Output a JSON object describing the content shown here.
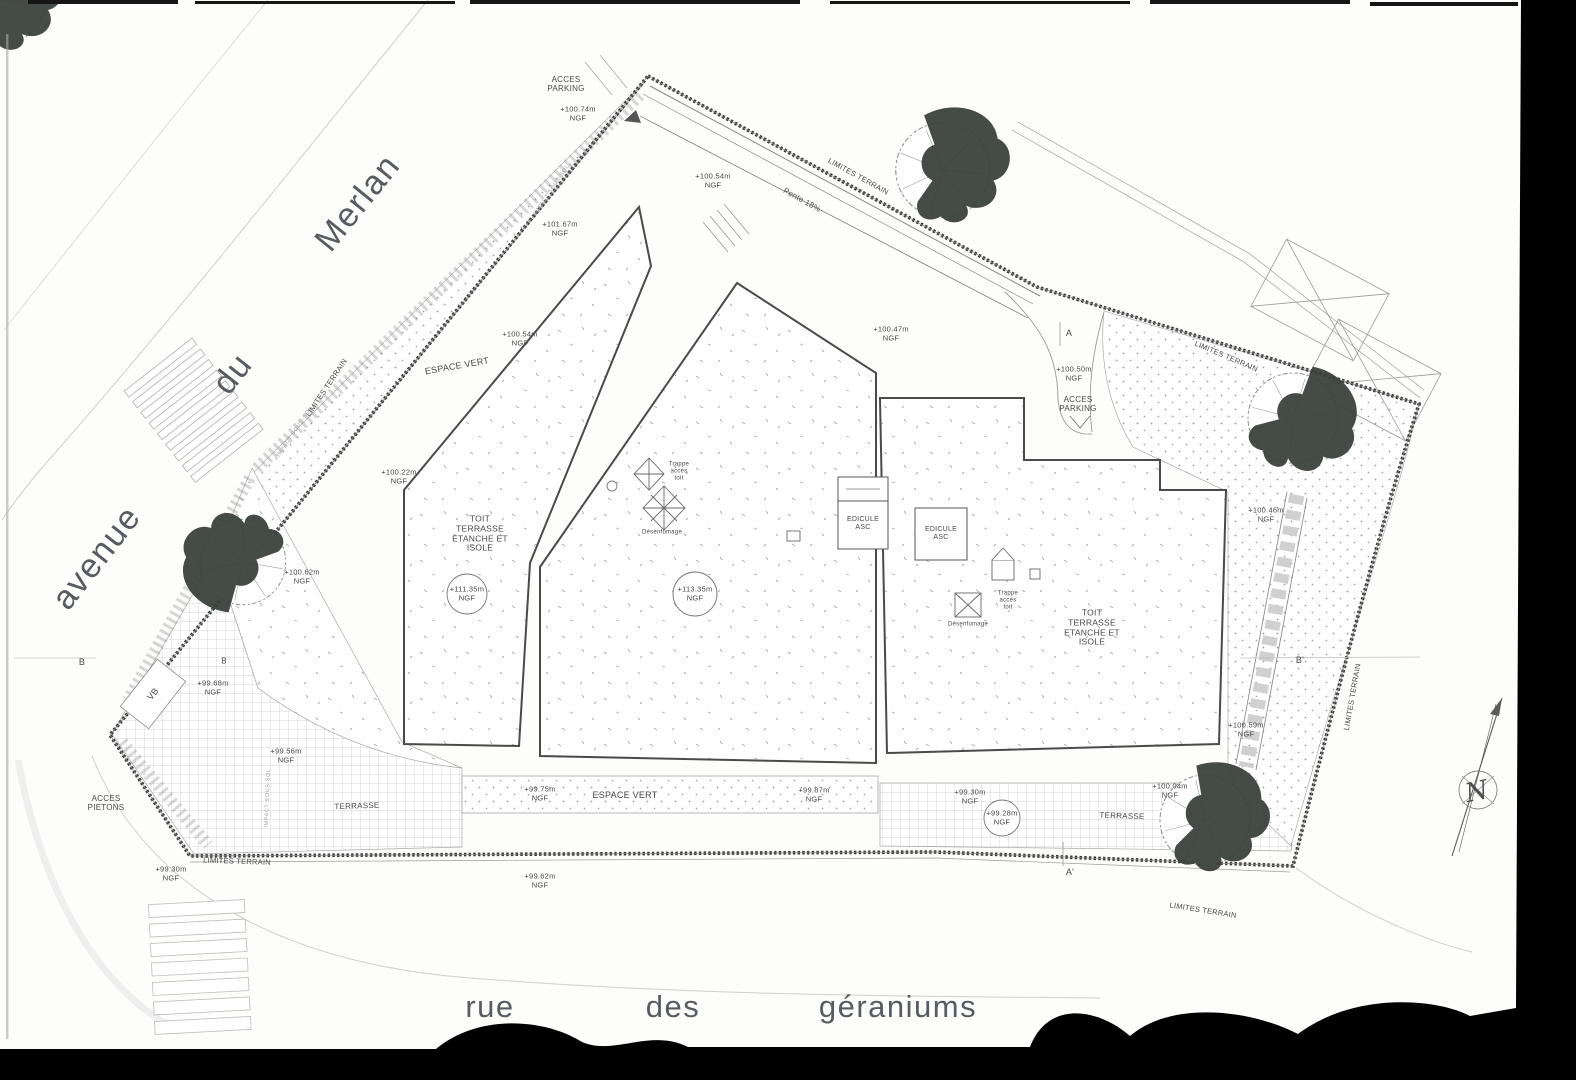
{
  "plan": {
    "type": "architect site plan (plan de masse) – roof level, scanned",
    "streets": {
      "avenue": "avenue du Merlan",
      "rue": "rue des géraniums"
    },
    "colors": {
      "ink": "#474747",
      "line": "#555555",
      "faint": "#bcbcbc",
      "scan_border": "#000000",
      "tree": "#39403b"
    },
    "labels": [
      {
        "name": "street-word-avenue",
        "cls": "street",
        "lines": [
          "avenue"
        ],
        "x": 97,
        "y": 558,
        "rot": -52,
        "size": 34
      },
      {
        "name": "street-word-du",
        "cls": "street",
        "lines": [
          "du"
        ],
        "x": 233,
        "y": 374,
        "rot": -52,
        "size": 34
      },
      {
        "name": "street-word-merlan",
        "cls": "street",
        "lines": [
          "Merlan"
        ],
        "x": 358,
        "y": 203,
        "rot": -51,
        "size": 34
      },
      {
        "name": "street-word-rue",
        "cls": "street",
        "lines": [
          "rue"
        ],
        "x": 490,
        "y": 1007,
        "rot": 0,
        "size": 31
      },
      {
        "name": "street-word-des",
        "cls": "street",
        "lines": [
          "des"
        ],
        "x": 673,
        "y": 1007,
        "rot": 0,
        "size": 31
      },
      {
        "name": "street-word-geraniums",
        "cls": "street",
        "lines": [
          "géraniums"
        ],
        "x": 898,
        "y": 1007,
        "rot": 0,
        "size": 31
      },
      {
        "name": "limites-terrain-left",
        "lines": [
          "LIMITES TERRAIN"
        ],
        "x": 327,
        "y": 388,
        "rot": -56,
        "size": 7.5
      },
      {
        "name": "limites-terrain-top",
        "lines": [
          "LIMITES TERRAIN"
        ],
        "x": 858,
        "y": 177,
        "rot": 29,
        "size": 7.5
      },
      {
        "name": "limites-terrain-topright",
        "lines": [
          "LIMITES TERRAIN"
        ],
        "x": 1226,
        "y": 357,
        "rot": 23,
        "size": 7.5
      },
      {
        "name": "limites-terrain-bottomleft",
        "lines": [
          "LIMITES TERRAIN"
        ],
        "x": 237,
        "y": 862,
        "rot": 2,
        "size": 7.5
      },
      {
        "name": "limites-terrain-bottomright",
        "lines": [
          "LIMITES TERRAIN"
        ],
        "x": 1203,
        "y": 911,
        "rot": 9,
        "size": 7.5
      },
      {
        "name": "limites-terrain-right",
        "lines": [
          "LIMITES TERRAIN"
        ],
        "x": 1353,
        "y": 697,
        "rot": -80,
        "size": 7.5
      },
      {
        "name": "acces-parking-top",
        "lines": [
          "ACCES",
          "PARKING"
        ],
        "x": 566,
        "y": 84,
        "rot": 0,
        "size": 8
      },
      {
        "name": "acces-parking-right",
        "lines": [
          "ACCES",
          "PARKING"
        ],
        "x": 1078,
        "y": 404,
        "rot": 0,
        "size": 8
      },
      {
        "name": "acces-pietons",
        "lines": [
          "ACCES",
          "PIETONS"
        ],
        "x": 106,
        "y": 803,
        "rot": 0,
        "size": 8
      },
      {
        "name": "pente-label",
        "lines": [
          "Pente 18%"
        ],
        "x": 802,
        "y": 200,
        "rot": 29,
        "size": 8
      },
      {
        "name": "espace-vert-top",
        "lines": [
          "ESPACE VERT"
        ],
        "x": 457,
        "y": 366,
        "rot": -10,
        "size": 9
      },
      {
        "name": "espace-vert-bottom",
        "lines": [
          "ESPACE VERT"
        ],
        "x": 625,
        "y": 795,
        "rot": 0,
        "size": 9
      },
      {
        "name": "terrasse-left",
        "lines": [
          "TERRASSE"
        ],
        "x": 357,
        "y": 806,
        "rot": -2,
        "size": 8
      },
      {
        "name": "terrasse-right",
        "lines": [
          "TERRASSE"
        ],
        "x": 1122,
        "y": 816,
        "rot": 2,
        "size": 8
      },
      {
        "name": "toit-terrasse-left",
        "lines": [
          "TOIT",
          "TERRASSE",
          "ETANCHE ET",
          "ISOLE"
        ],
        "x": 480,
        "y": 534,
        "rot": 0,
        "size": 8.5
      },
      {
        "name": "toit-terrasse-right",
        "lines": [
          "TOIT",
          "TERRASSE",
          "ETANCHE ET",
          "ISOLE"
        ],
        "x": 1092,
        "y": 628,
        "rot": 0,
        "size": 8.5
      },
      {
        "name": "edicule-asc-left",
        "lines": [
          "EDICULE",
          "ASC"
        ],
        "x": 863,
        "y": 524,
        "rot": 0,
        "size": 7
      },
      {
        "name": "edicule-asc-right",
        "lines": [
          "EDICULE",
          "ASC"
        ],
        "x": 941,
        "y": 534,
        "rot": 0,
        "size": 7
      },
      {
        "name": "trappe-acces-toit-mid",
        "lines": [
          "Trappe",
          "accès",
          "toit"
        ],
        "x": 679,
        "y": 472,
        "rot": 0,
        "size": 6
      },
      {
        "name": "trappe-acces-toit-right",
        "lines": [
          "Trappe",
          "accès",
          "toit"
        ],
        "x": 1008,
        "y": 601,
        "rot": 0,
        "size": 6
      },
      {
        "name": "desenfumage-mid",
        "lines": [
          "Désenfumage"
        ],
        "x": 662,
        "y": 533,
        "rot": 0,
        "size": 6
      },
      {
        "name": "desenfumage-right",
        "lines": [
          "Désenfumage"
        ],
        "x": 968,
        "y": 625,
        "rot": 0,
        "size": 6
      },
      {
        "name": "marker-vb",
        "lines": [
          "VB"
        ],
        "x": 153,
        "y": 694,
        "rot": -52,
        "size": 9
      },
      {
        "name": "section-marker-a",
        "lines": [
          "A"
        ],
        "x": 1069,
        "y": 333,
        "rot": 0,
        "size": 9
      },
      {
        "name": "section-marker-a-prime",
        "lines": [
          "A'"
        ],
        "x": 1070,
        "y": 872,
        "rot": 0,
        "size": 9
      },
      {
        "name": "section-marker-b",
        "lines": [
          "B"
        ],
        "x": 82,
        "y": 662,
        "rot": 0,
        "size": 9
      },
      {
        "name": "section-marker-b-small",
        "lines": [
          "B"
        ],
        "x": 224,
        "y": 661,
        "rot": 0,
        "size": 8
      },
      {
        "name": "section-marker-b-prime",
        "lines": [
          "B'"
        ],
        "x": 1300,
        "y": 660,
        "rot": 0,
        "size": 9
      },
      {
        "name": "impact-sous-sol-1",
        "cls": "faint",
        "lines": [
          "IMPACT SOUS-SOL"
        ],
        "x": 552,
        "y": 190,
        "rot": -56,
        "size": 5.5
      },
      {
        "name": "impact-sous-sol-2",
        "cls": "faint",
        "lines": [
          "IMPACT SOUS-SOL"
        ],
        "x": 295,
        "y": 432,
        "rot": -56,
        "size": 5.5
      },
      {
        "name": "impact-sous-sol-3",
        "cls": "faint",
        "lines": [
          "IMPACT SOUS-SOL"
        ],
        "x": 268,
        "y": 798,
        "rot": -88,
        "size": 5.5
      },
      {
        "name": "compass-north-letter",
        "cls": "compass",
        "lines": [
          "N"
        ],
        "x": 1477,
        "y": 793,
        "rot": -12,
        "size": 26
      },
      {
        "name": "elev-100-74",
        "lines": [
          "+100.74m",
          "NGF"
        ],
        "x": 578,
        "y": 114,
        "rot": 0,
        "size": 7.5
      },
      {
        "name": "elev-100-54-a",
        "lines": [
          "+100.54m",
          "NGF"
        ],
        "x": 713,
        "y": 181,
        "rot": 0,
        "size": 7.5
      },
      {
        "name": "elev-101-67",
        "lines": [
          "+101.67m",
          "NGF"
        ],
        "x": 560,
        "y": 229,
        "rot": 0,
        "size": 7.5
      },
      {
        "name": "elev-100-54-b",
        "lines": [
          "+100.54m",
          "NGF"
        ],
        "x": 520,
        "y": 339,
        "rot": 0,
        "size": 7.5
      },
      {
        "name": "elev-100-22",
        "lines": [
          "+100.22m",
          "NGF"
        ],
        "x": 399,
        "y": 477,
        "rot": 0,
        "size": 7.5
      },
      {
        "name": "elev-100-47",
        "lines": [
          "+100.47m",
          "NGF"
        ],
        "x": 891,
        "y": 334,
        "rot": 0,
        "size": 7.5
      },
      {
        "name": "elev-100-50",
        "lines": [
          "+100.50m",
          "NGF"
        ],
        "x": 1074,
        "y": 374,
        "rot": 0,
        "size": 7.5
      },
      {
        "name": "elev-100-62",
        "lines": [
          "+100.62m",
          "NGF"
        ],
        "x": 302,
        "y": 577,
        "rot": 0,
        "size": 7.5
      },
      {
        "name": "elev-100-46",
        "lines": [
          "+100.46m",
          "NGF"
        ],
        "x": 1266,
        "y": 515,
        "rot": 0,
        "size": 7.5
      },
      {
        "name": "elev-111-35-circled",
        "lines": [
          "+111.35m",
          "NGF"
        ],
        "x": 467,
        "y": 594,
        "rot": 0,
        "size": 7.5
      },
      {
        "name": "elev-113-35-circled",
        "lines": [
          "+113.35m",
          "NGF"
        ],
        "x": 695,
        "y": 594,
        "rot": 0,
        "size": 7.5
      },
      {
        "name": "elev-99-68",
        "lines": [
          "+99.68m",
          "NGF"
        ],
        "x": 213,
        "y": 688,
        "rot": 0,
        "size": 7.5
      },
      {
        "name": "elev-99-56",
        "lines": [
          "+99.56m",
          "NGF"
        ],
        "x": 286,
        "y": 756,
        "rot": 0,
        "size": 7.5
      },
      {
        "name": "elev-99-30-left",
        "lines": [
          "+99.30m",
          "NGF"
        ],
        "x": 171,
        "y": 874,
        "rot": 0,
        "size": 7.5
      },
      {
        "name": "elev-99-62",
        "lines": [
          "+99.62m",
          "NGF"
        ],
        "x": 540,
        "y": 881,
        "rot": 0,
        "size": 7.5
      },
      {
        "name": "elev-99-75",
        "lines": [
          "+99.75m",
          "NGF"
        ],
        "x": 540,
        "y": 794,
        "rot": 0,
        "size": 7.5
      },
      {
        "name": "elev-99-87",
        "lines": [
          "+99.87m",
          "NGF"
        ],
        "x": 814,
        "y": 795,
        "rot": 0,
        "size": 7.5
      },
      {
        "name": "elev-99-30-right",
        "lines": [
          "+99.30m",
          "NGF"
        ],
        "x": 970,
        "y": 797,
        "rot": 0,
        "size": 7.5
      },
      {
        "name": "elev-99-28-circled",
        "lines": [
          "+99.28m",
          "NGF"
        ],
        "x": 1002,
        "y": 818,
        "rot": 0,
        "size": 7.5
      },
      {
        "name": "elev-100-04",
        "lines": [
          "+100.04m",
          "NGF"
        ],
        "x": 1170,
        "y": 791,
        "rot": 0,
        "size": 7.5
      },
      {
        "name": "elev-100-59",
        "lines": [
          "+100.59m",
          "NGF"
        ],
        "x": 1246,
        "y": 730,
        "rot": 0,
        "size": 7.5
      }
    ]
  }
}
